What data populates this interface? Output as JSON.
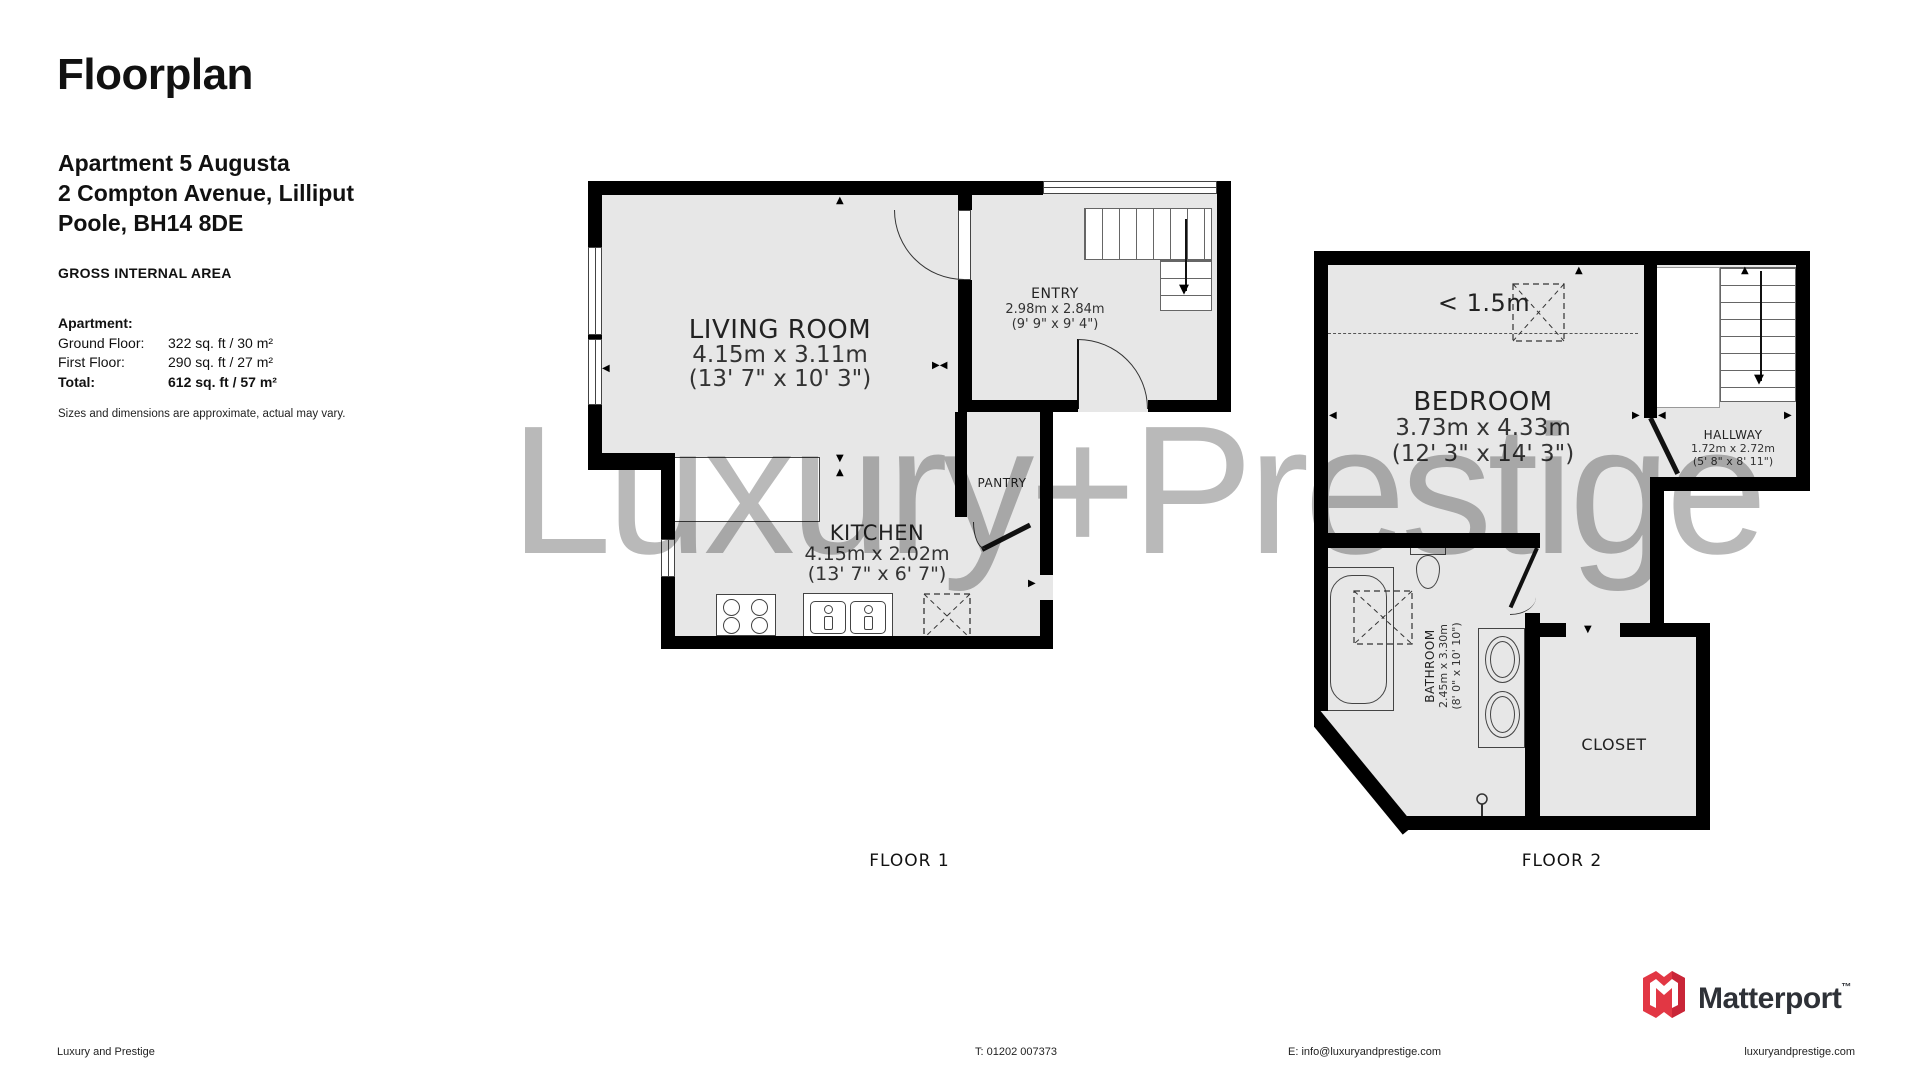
{
  "header": {
    "title": "Floorplan",
    "address_line1": "Apartment 5 Augusta",
    "address_line2": "2 Compton Avenue, Lilliput",
    "address_line3": "Poole, BH14 8DE",
    "gia_heading": "GROSS INTERNAL AREA",
    "table": {
      "group_label": "Apartment:",
      "rows": [
        {
          "label": "Ground Floor:",
          "value": "322 sq. ft / 30 m²"
        },
        {
          "label": "First Floor:",
          "value": "290 sq. ft / 27 m²"
        },
        {
          "label": "Total:",
          "value": "612 sq. ft / 57 m²"
        }
      ]
    },
    "disclaimer": "Sizes and dimensions are approximate, actual may vary."
  },
  "watermark": "Luxury+Prestige",
  "floor1": {
    "label": "FLOOR 1",
    "rooms": {
      "living_room": {
        "name": "LIVING ROOM",
        "dims_metric": "4.15m x 3.11m",
        "dims_imperial": "(13' 7\" x 10' 3\")"
      },
      "entry": {
        "name": "ENTRY",
        "dims_metric": "2.98m x 2.84m",
        "dims_imperial": "(9' 9\" x 9' 4\")"
      },
      "kitchen": {
        "name": "KITCHEN",
        "dims_metric": "4.15m x 2.02m",
        "dims_imperial": "(13' 7\" x 6' 7\")"
      },
      "pantry": {
        "name": "PANTRY"
      }
    }
  },
  "floor2": {
    "label": "FLOOR 2",
    "headroom_note": "< 1.5m",
    "rooms": {
      "bedroom": {
        "name": "BEDROOM",
        "dims_metric": "3.73m x 4.33m",
        "dims_imperial": "(12' 3\" x 14' 3\")"
      },
      "hallway": {
        "name": "HALLWAY",
        "dims_metric": "1.72m x 2.72m",
        "dims_imperial": "(5' 8\" x 8' 11\")"
      },
      "bathroom": {
        "name": "BATHROOM",
        "dims_metric": "2.45m x 3.30m",
        "dims_imperial": "(8' 0\" x 10' 10\")"
      },
      "closet": {
        "name": "CLOSET"
      }
    }
  },
  "footer": {
    "company": "Luxury and Prestige",
    "phone": "T: 01202 007373",
    "email": "E: info@luxuryandprestige.com",
    "website": "luxuryandprestige.com",
    "logo_text": "Matterport",
    "logo_tm": "™"
  },
  "colors": {
    "wall": "#000000",
    "floor_fill": "#e7e7e7",
    "watermark_gray": "#b9b9b9",
    "matterport_red": "#e23744",
    "matterport_dark_red": "#a81c30",
    "logo_text_color": "#2e3137"
  }
}
